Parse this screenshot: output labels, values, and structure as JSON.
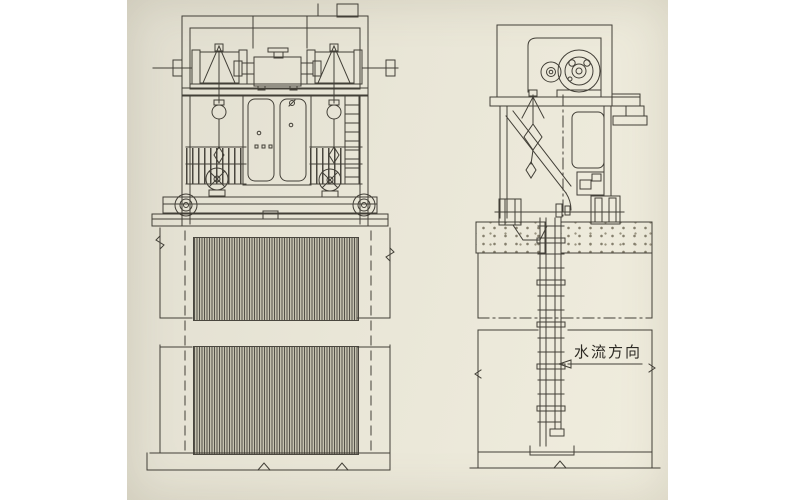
{
  "scene": {
    "background_color": "#ffffff",
    "paper_color": "#e9e6d8",
    "ink_color": "#423f37",
    "screen_hatch_color": "#55534a"
  },
  "annotation": {
    "flow_label": "水流方向",
    "flow_arrow_direction": "left"
  }
}
